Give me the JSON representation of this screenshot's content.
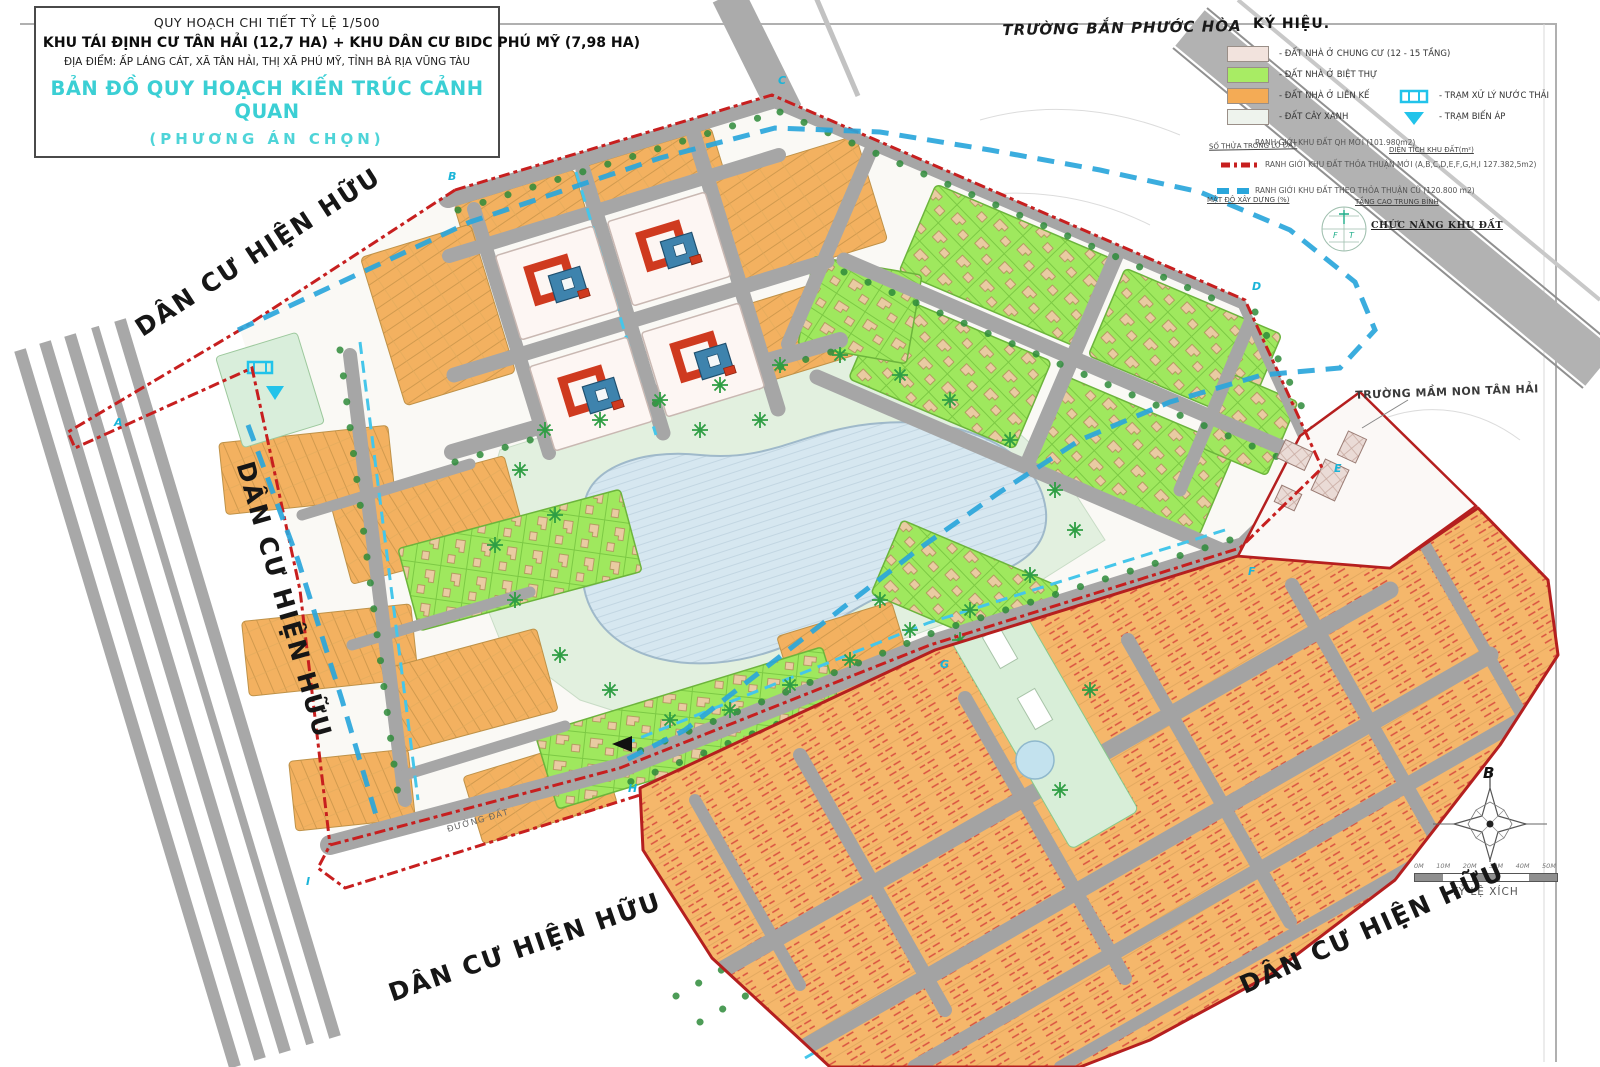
{
  "title_block": {
    "line1": "QUY HOẠCH CHI TIẾT TỶ LỆ 1/500",
    "line2": "KHU TÁI ĐỊNH CƯ TÂN HẢI (12,7 HA) + KHU DÂN CƯ BIDC PHÚ MỸ (7,98 HA)",
    "line3": "ĐỊA ĐIỂM: ẤP LÁNG CÁT, XÃ TÂN HẢI, THỊ XÃ PHÚ MỸ, TỈNH BÀ RỊA VŨNG TÀU",
    "line4": "BẢN ĐỒ QUY HOẠCH KIẾN TRÚC CẢNH QUAN",
    "line5": "(PHƯƠNG ÁN CHỌN)"
  },
  "legend": {
    "heading": "KÝ HIỆU.",
    "land_items": [
      {
        "label": "-  ĐẤT NHÀ Ở CHUNG CƯ (12 - 15 TẦNG)",
        "color": "#f2e3dd"
      },
      {
        "label": "-  ĐẤT NHÀ Ở BIỆT THỰ",
        "color": "#a8ec64"
      },
      {
        "label": "-  ĐẤT NHÀ Ở LIÊN KẾ",
        "color": "#f4ab55"
      },
      {
        "label": "-  ĐẤT CÂY XANH",
        "color": "#eef3ed"
      }
    ],
    "facility_items": [
      {
        "label": "-  TRẠM XỬ LÝ NƯỚC THẢI"
      },
      {
        "label": "-  TRẠM BIẾN ÁP"
      }
    ],
    "boundary_items": [
      {
        "label": "RANH GIỚI KHU ĐẤT QH MỚI (101.980m2)"
      },
      {
        "label": "RANH GIỚI KHU ĐẤT THỎA THUẬN MỚI (A,B,C,D,E,F,G,H,I 127.382,5m2)"
      },
      {
        "label": "RANH GIỚI KHU ĐẤT THEO THỎA THUẬN CŨ (120.800 m2)"
      }
    ],
    "annotations": {
      "parcel_no": "SỐ THỬA TRONG LÔ ĐẤT",
      "area": "DIỆN TÍCH KHU ĐẤT(m²)",
      "density": "MẬT ĐỘ XÂY DỰNG (%)",
      "height": "TẦNG CAO TRUNG BÌNH",
      "function": "CHỨC NĂNG KHU ĐẤT"
    }
  },
  "map_labels": {
    "existing_1": "DÂN CƯ HIỆN HỮU",
    "existing_2": "DÂN CƯ HIỆN HỮU",
    "existing_3": "DÂN CƯ HIỆN HỮU",
    "existing_4": "DÂN CƯ HIỆN HỮU",
    "shooting_range": "TRƯỜNG BẮN PHƯỚC HÒA",
    "kindergarten": "TRƯỜNG MẦM NON TÂN HẢI",
    "dirt_road": "ĐƯỜNG ĐẤT"
  },
  "corner_letters": [
    {
      "t": "A"
    },
    {
      "t": "B"
    },
    {
      "t": "C"
    },
    {
      "t": "D"
    },
    {
      "t": "E"
    },
    {
      "t": "F"
    },
    {
      "t": "G"
    },
    {
      "t": "H"
    },
    {
      "t": "I"
    }
  ],
  "compass": {
    "north_label": "B"
  },
  "scale_bar": {
    "ticks": [
      "0M",
      "10M",
      "20M",
      "30M",
      "40M",
      "50M"
    ],
    "caption": "TỶ LỆ XÍCH"
  },
  "colors": {
    "accent_cyan": "#3bcfd4",
    "boundary_red": "#c71f1f",
    "boundary_blue": "#2aa6db",
    "lot_orange": "#f3b160",
    "villa_green": "#9fe85e",
    "park_green": "#e2f0df",
    "lake_blue": "#d6e7f0",
    "road_gray": "#a8a8a8",
    "building_red": "#cf3a1f",
    "building_blue": "#3e83ad",
    "facility_cyan": "#22c3ea"
  }
}
